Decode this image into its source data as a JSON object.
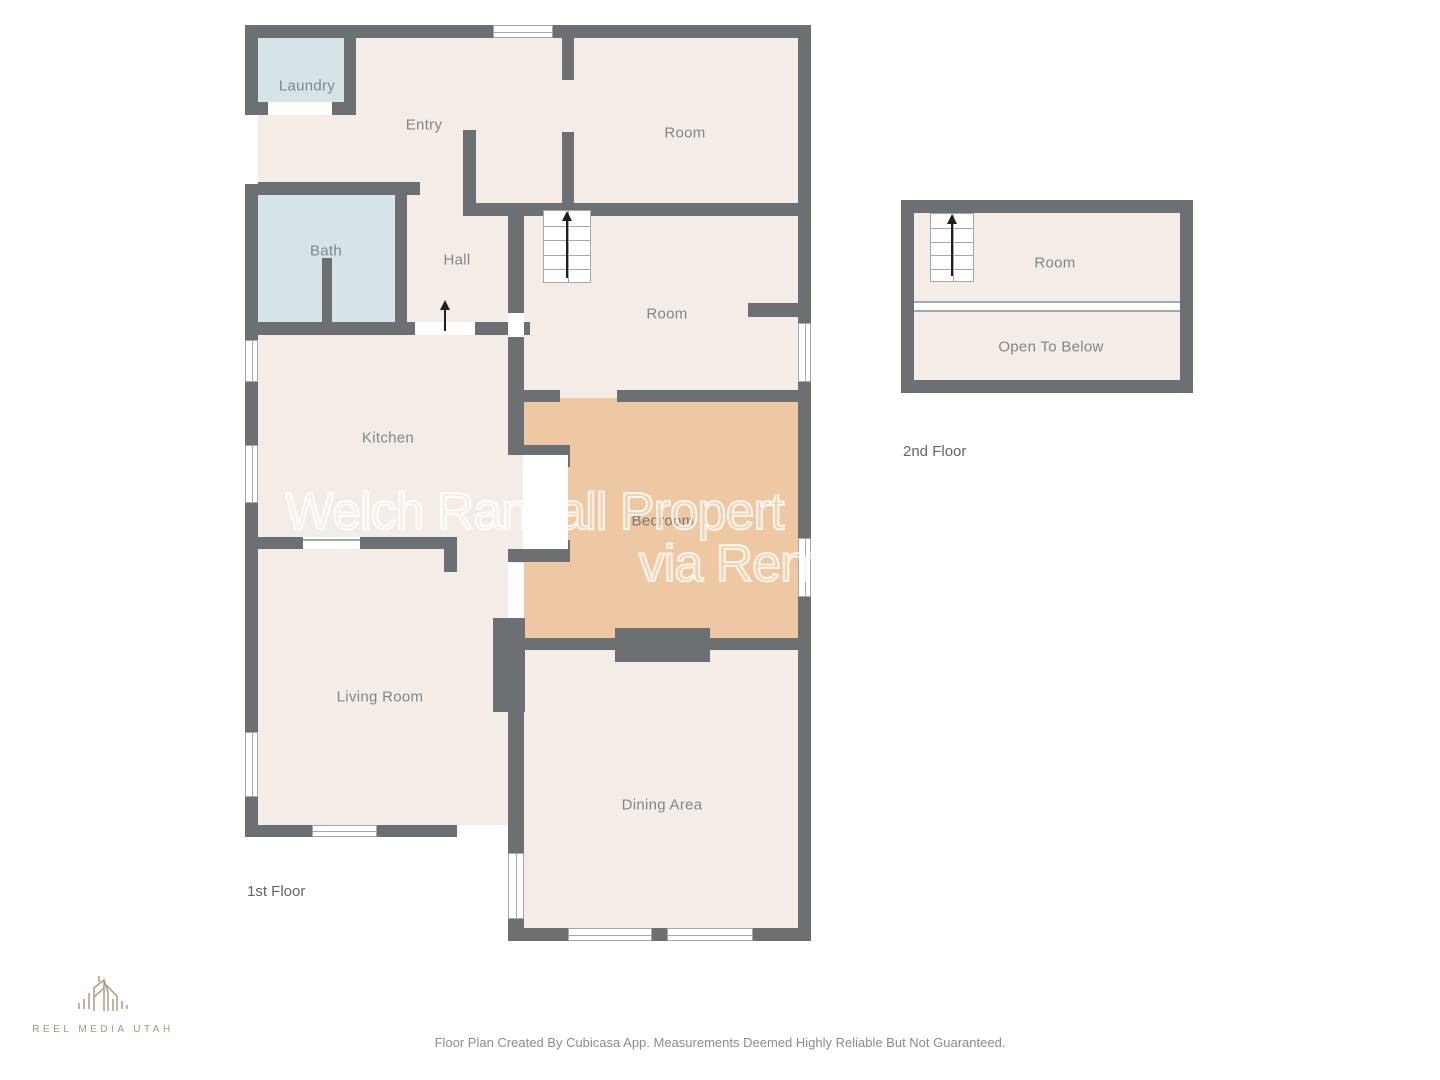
{
  "plan_title_rooms_first_floor": "floor plan of a house, 1st and 2nd floor",
  "rooms": [
    {
      "id": "laundry",
      "label": "Laundry"
    },
    {
      "id": "entry",
      "label": "Entry"
    },
    {
      "id": "room-top",
      "label": "Room"
    },
    {
      "id": "bath",
      "label": "Bath"
    },
    {
      "id": "hall",
      "label": "Hall"
    },
    {
      "id": "room-middle",
      "label": "Room"
    },
    {
      "id": "kitchen",
      "label": "Kitchen"
    },
    {
      "id": "bedroom",
      "label": "Bedroom"
    },
    {
      "id": "living-room",
      "label": "Living Room"
    },
    {
      "id": "dining-area",
      "label": "Dining Area"
    },
    {
      "id": "room-second-floor",
      "label": "Room"
    },
    {
      "id": "open-to-below",
      "label": "Open To Below"
    }
  ],
  "captions": {
    "first_floor": "1st Floor",
    "second_floor": "2nd Floor"
  },
  "watermark": {
    "line1": "Welch Randall Propert",
    "line2": "via Rentl"
  },
  "logo": {
    "text": "REEL MEDIA UTAH"
  },
  "footer": "Floor Plan Created By Cubicasa App. Measurements Deemed Highly Reliable But Not Guaranteed.",
  "colors": {
    "wall": "#6d7072",
    "floor": "#f4ede7",
    "wet": "#d7e4e7",
    "bedroom": "#eec8a2",
    "label": "#80868b",
    "stair_line": "#a3a8ab",
    "logo": "#a9947a",
    "footer": "#8c8c8c",
    "floor_label": "#60666a",
    "arrow": "#1f1f1f",
    "watermark": "rgba(255,255,255,0.8)"
  }
}
